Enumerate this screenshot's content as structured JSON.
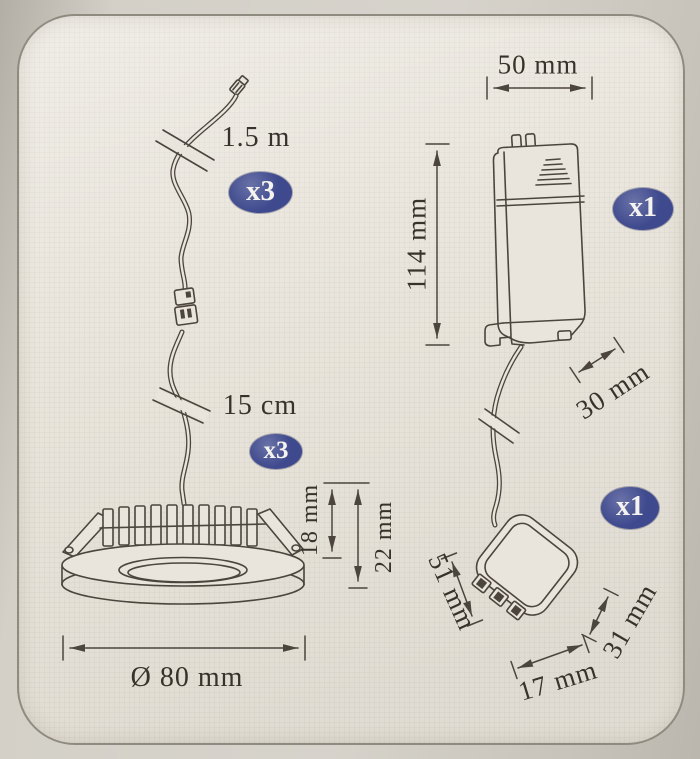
{
  "colors": {
    "page_bg": "#cfcbc2",
    "card_bg": "#e9e5dc",
    "card_border": "#908b81",
    "line": "#4b453e",
    "text": "#37322c",
    "badge_bg": "#3f4a8e",
    "badge_text": "#f5f3ee"
  },
  "diagram": {
    "cable": {
      "length_label": "1.5 m",
      "qty_badge": "x3"
    },
    "fixture": {
      "pigtail_label": "15 cm",
      "qty_badge": "x3",
      "recess_depth": "18 mm",
      "overall_depth": "22 mm",
      "diameter": "Ø 80 mm"
    },
    "driver": {
      "width": "50 mm",
      "height": "114 mm",
      "depth": "30 mm",
      "qty_badge": "x1"
    },
    "distribution_block": {
      "qty_badge": "x1",
      "length": "51 mm",
      "height": "31 mm",
      "depth": "17 mm"
    }
  }
}
